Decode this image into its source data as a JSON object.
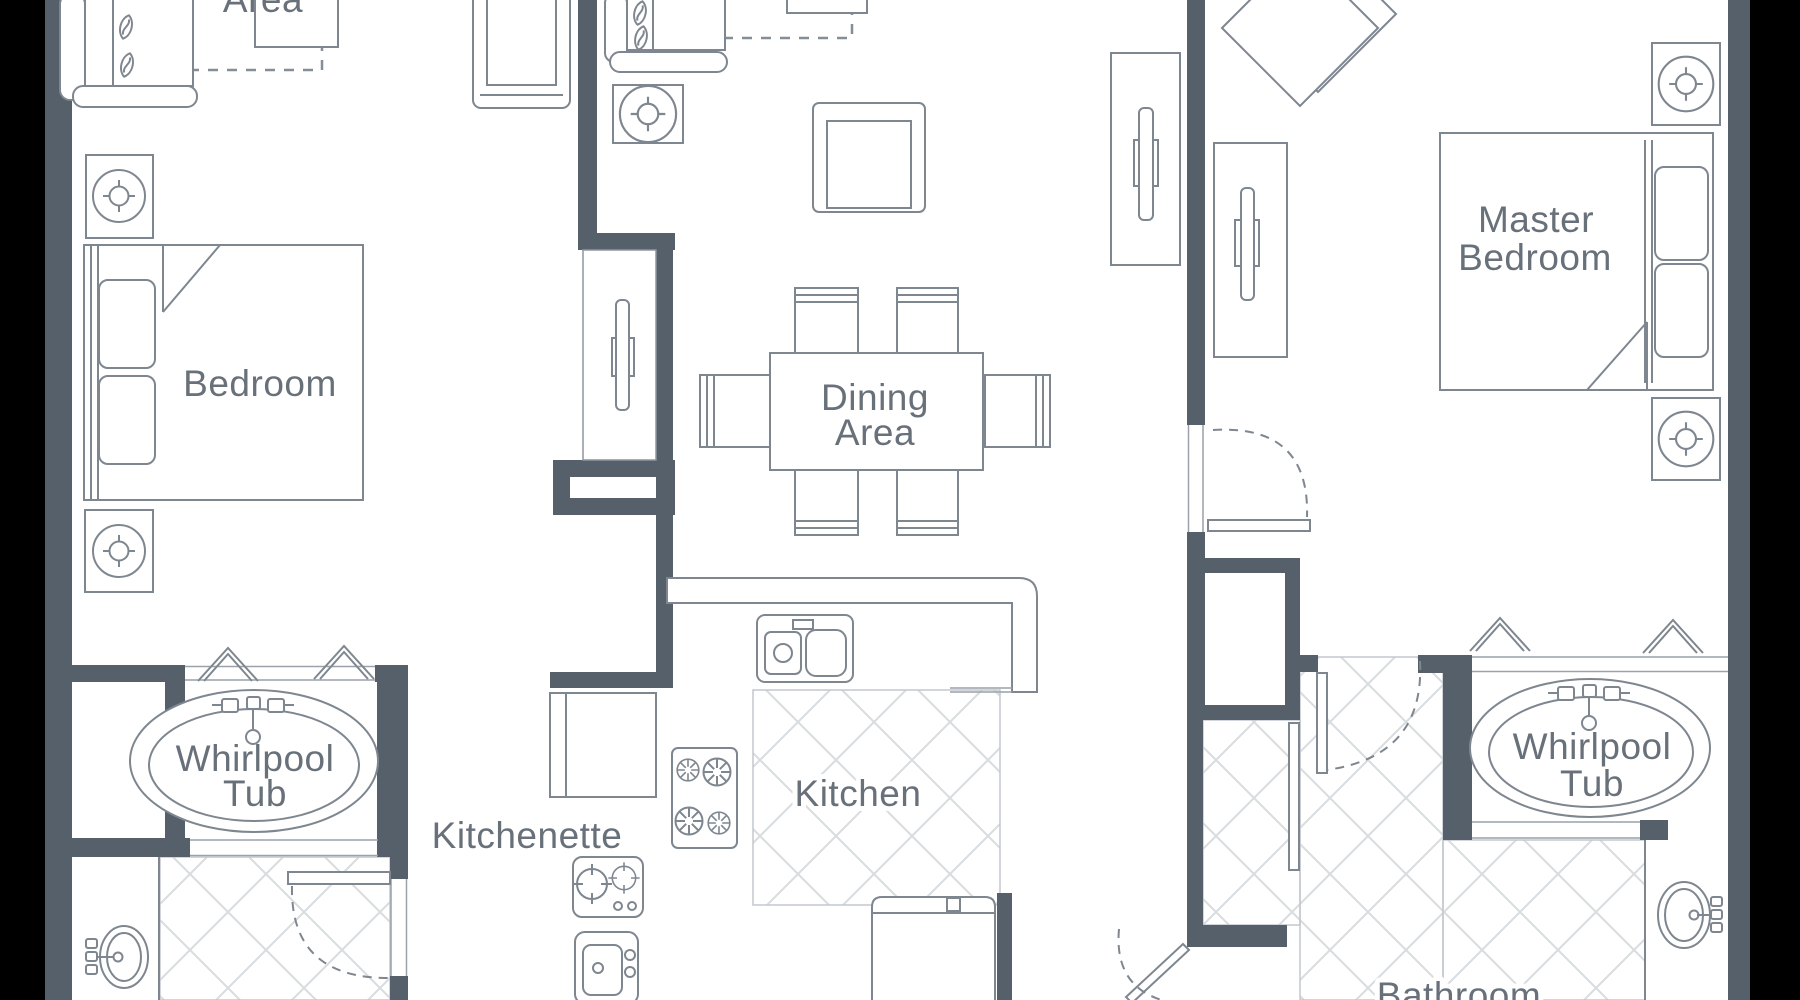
{
  "plan": {
    "title": "Two-bedroom suite floor plan",
    "labels": {
      "area_partial": "Area",
      "bedroom": "Bedroom",
      "dining1": "Dining",
      "dining2": "Area",
      "kitchen": "Kitchen",
      "kitchenette": "Kitchenette",
      "master1": "Master",
      "master2": "Bedroom",
      "whirlpool_left1": "Whirlpool",
      "whirlpool_left2": "Tub",
      "whirlpool_right1": "Whirlpool",
      "whirlpool_right2": "Tub",
      "bathroom": "Bathroom"
    },
    "colors": {
      "letterbox": "#000000",
      "paper": "#ffffff",
      "wall": "#56606b",
      "furniture_line": "#7e868f",
      "light_line": "#9aa1a9",
      "tile_line": "#d7dcdf",
      "text": "#68707a"
    },
    "icons": {
      "lamp": "circle-with-flower-center",
      "burner": "eight-spoke-circle",
      "kitchenette_burner": "circle-with-cross-ticks",
      "chevron_marker": "double-line-peak",
      "faucet": "tap-with-two-handles",
      "door_swing": "dashed-quarter-arc",
      "tile_floor": "diagonal-lattice",
      "pillow": "leaf-shape",
      "tv": "slim-bar-with-bracket"
    }
  }
}
